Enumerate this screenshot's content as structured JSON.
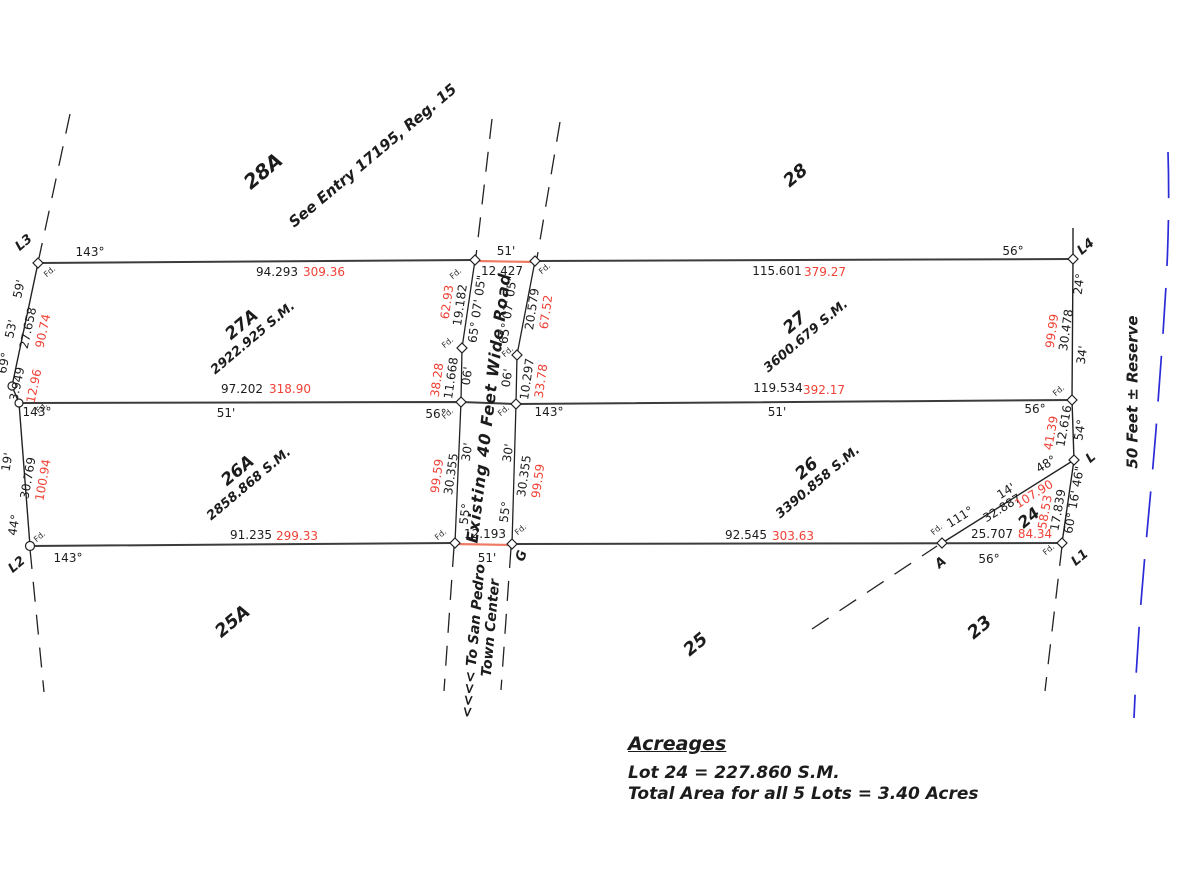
{
  "colors": {
    "red_text": "#ef4136",
    "red_line": "#ef7a63",
    "blue_reserve": "#2b2bd8",
    "black_line": "#3c3c3c"
  },
  "points": {
    "l3": "L3",
    "l2": "L2",
    "l4": "L4",
    "l1": "L1",
    "l": "L",
    "g": "G",
    "a": "A",
    "fd": "Fd."
  },
  "lots": {
    "lot28a": "28A",
    "lot28": "28",
    "lot25a": "25A",
    "lot25": "25",
    "lot23": "23",
    "lot24": "24",
    "lot27a": "27A",
    "lot27a_area": "2922.925 S.M.",
    "lot27": "27",
    "lot27_area": "3600.679 S.M.",
    "lot26a": "26A",
    "lot26a_area": "2858.868 S.M.",
    "lot26": "26",
    "lot26_area": "3390.858 S.M."
  },
  "notes": {
    "entry": "See Entry 17195, Reg. 15",
    "road_name": "Existing 40 Feet Wide Road",
    "dest_line1": "<<<< To San Pedro",
    "dest_line2": "Town Center",
    "reserve": "50 Feet ± Reserve"
  },
  "acreages": {
    "title": "Acreages",
    "lot24_line": "Lot 24 = 227.860 S.M.",
    "total_line": "Total Area for all 5 Lots = 3.40 Acres"
  },
  "meas": {
    "left": {
      "brg_top": "143°",
      "t59": "59'",
      "t53": "53'",
      "d1": "27.658",
      "m1": "90.74",
      "brg69": "69°",
      "d2": "3.949",
      "m2": "12.96",
      "brg_mid": "143°",
      "t19": "19'",
      "d3": "30.769",
      "m3": "100.94",
      "brg44": "44°",
      "brg_bot": "143°"
    },
    "top": {
      "d1": "94.293",
      "m1": "309.36",
      "w51": "51'",
      "gap": "12.427",
      "d2": "115.601",
      "m2": "379.27",
      "brg56": "56°"
    },
    "mid": {
      "d1": "97.202",
      "m1": "318.90",
      "t51a": "51'",
      "brg56a": "56°",
      "brg143": "143°",
      "d2": "119.534",
      "m2": "392.17",
      "t51b": "51'",
      "brg56b": "56°"
    },
    "bot": {
      "d1": "91.235",
      "m1": "299.33",
      "w51": "51'",
      "gap": "12.193",
      "d2": "92.545",
      "m2": "303.63",
      "d3": "25.707",
      "m3": "84.34",
      "brg56": "56°"
    },
    "road": {
      "brg_w": "65° 07' 05\"",
      "brg_e": "65° 07' 05\"",
      "du1": "19.182",
      "mu1": "62.93",
      "du2": "20.579",
      "mu2": "67.52",
      "dv1": "11.668",
      "mv1": "38.28",
      "dv2": "10.297",
      "mv2": "33.78",
      "t06a": "06'",
      "t06b": "06'",
      "t30a": "30'",
      "t30b": "30'",
      "dx1": "30.355",
      "mx1": "99.59",
      "dx2": "30.355",
      "mx2": "99.59",
      "t55a": "55°",
      "t55b": "55°"
    },
    "right": {
      "brg24": "24°",
      "d1": "30.478",
      "m1": "99.99",
      "t34": "34'",
      "brg54": "54°",
      "d2": "12.616",
      "m2": "41.39",
      "brg48": "48°",
      "brg_l1": "60° 16' 46\"",
      "d3": "17.839",
      "m3": "58.53"
    },
    "lot24": {
      "brg111": "111°",
      "d1": "32.887",
      "t14": "14'",
      "m1": "107.90"
    }
  }
}
